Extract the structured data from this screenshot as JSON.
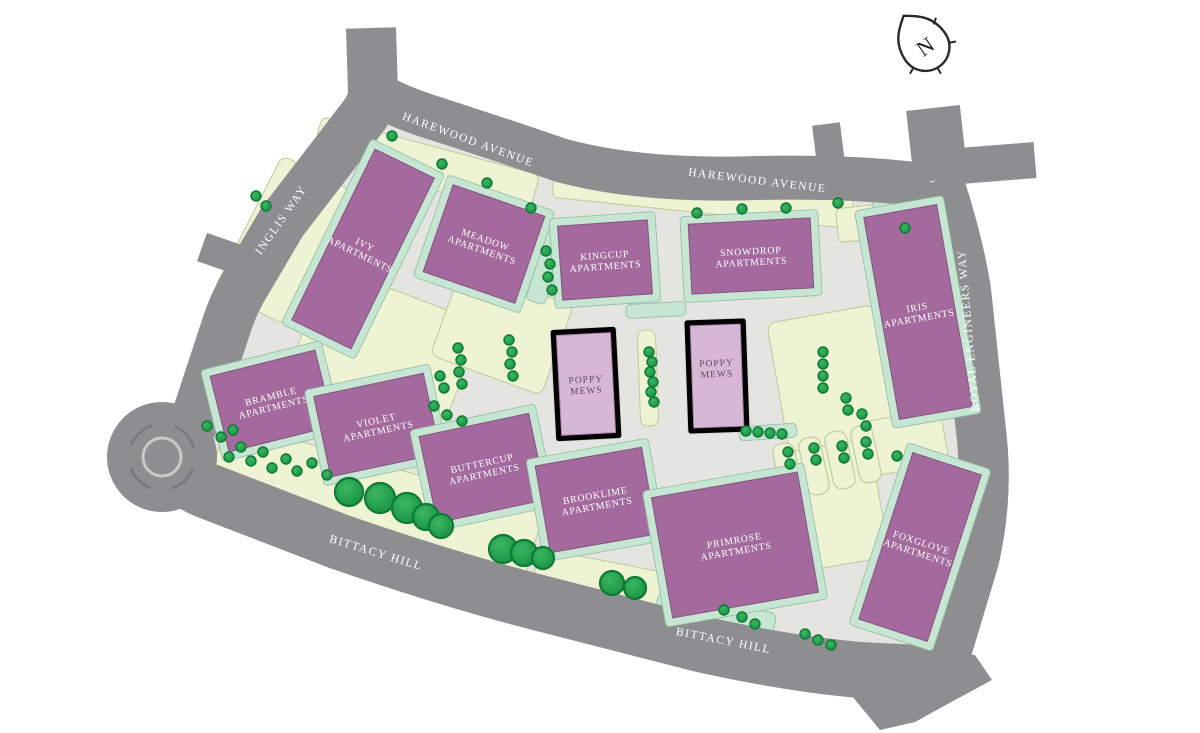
{
  "compass": {
    "letter": "N"
  },
  "roads": {
    "harewood_avenue_label_1": "HAREWOOD AVENUE",
    "harewood_avenue_label_2": "HAREWOOD AVENUE",
    "inglis_way_label": "INGLIS WAY",
    "royal_engineers_way_label": "ROYAL ENGINEERS WAY",
    "bittacy_hill_label_1": "BITTACY HILL",
    "bittacy_hill_label_2": "BITTACY HILL",
    "mill_hill_east_label": "MILL HILL EAST TUBE"
  },
  "buildings": [
    {
      "id": "ivy",
      "line1": "IVY",
      "line2": "APARTMENTS"
    },
    {
      "id": "meadow",
      "line1": "MEADOW",
      "line2": "APARTMENTS"
    },
    {
      "id": "kingcup",
      "line1": "KINGCUP",
      "line2": "APARTMENTS"
    },
    {
      "id": "snowdrop",
      "line1": "SNOWDROP",
      "line2": "APARTMENTS"
    },
    {
      "id": "iris",
      "line1": "IRIS",
      "line2": "APARTMENTS"
    },
    {
      "id": "bramble",
      "line1": "BRAMBLE",
      "line2": "APARTMENTS"
    },
    {
      "id": "violet",
      "line1": "VIOLET",
      "line2": "APARTMENTS"
    },
    {
      "id": "buttercup",
      "line1": "BUTTERCUP",
      "line2": "APARTMENTS"
    },
    {
      "id": "brooklime",
      "line1": "BROOKLIME",
      "line2": "APARTMENTS"
    },
    {
      "id": "primrose",
      "line1": "PRIMROSE",
      "line2": "APARTMENTS"
    },
    {
      "id": "foxglove",
      "line1": "FOXGLOVE",
      "line2": "APARTMENTS"
    },
    {
      "id": "poppy-mews-west",
      "line1": "POPPY",
      "line2": "MEWS"
    },
    {
      "id": "poppy-mews-east",
      "line1": "POPPY",
      "line2": "MEWS"
    }
  ],
  "colors": {
    "road": "#8e8e91",
    "pavement": "#e4e4e1",
    "lawn": "#eef3d3",
    "mint": "#c7e5d3",
    "building": "#a46a9d",
    "mews": "#d7b7d6",
    "tree": "#1f9c49",
    "building_label_text": "#ffffff",
    "mews_label_text": "#5e4a5c"
  }
}
